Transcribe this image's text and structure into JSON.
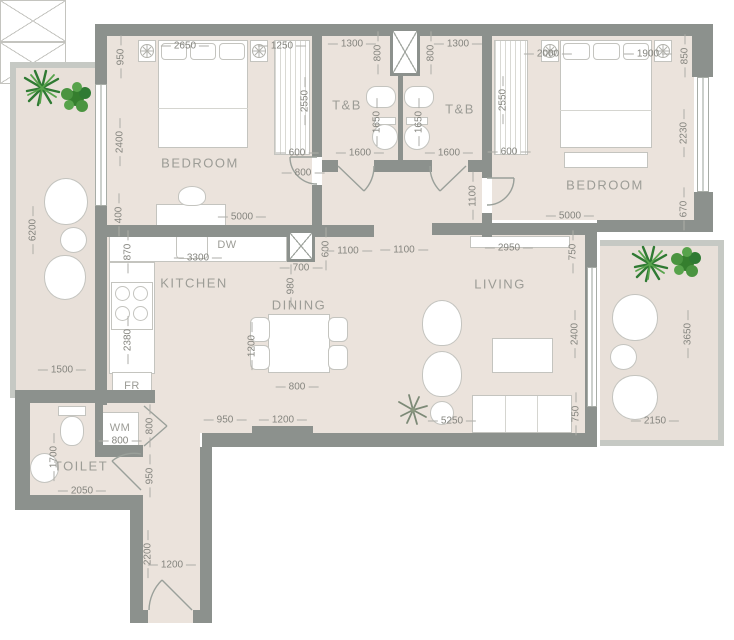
{
  "title": "apartment-floor-plan",
  "rooms": {
    "bedroom_left": "BEDROOM",
    "bedroom_right": "BEDROOM",
    "tb_left": "T&B",
    "tb_right": "T&B",
    "kitchen": "KITCHEN",
    "dining": "DINING",
    "living": "LIVING",
    "toilet": "TOILET"
  },
  "appliances": {
    "dishwasher": "DW",
    "fridge": "FR",
    "washing_machine": "WM"
  },
  "dims": {
    "top": [
      "2650",
      "1250",
      "1300",
      "800",
      "800",
      "1300",
      "2000",
      "1900",
      "850"
    ],
    "left_wall": [
      "950",
      "2400",
      "400"
    ],
    "left_balcony": [
      "6200",
      "1500"
    ],
    "closet_left": [
      "2550",
      "600"
    ],
    "closet_right": [
      "2550",
      "600"
    ],
    "tb": [
      "1650",
      "1650",
      "1600",
      "1600",
      "800",
      "1100"
    ],
    "bedroom_left": [
      "5000"
    ],
    "bedroom_right": [
      "5000",
      "2230",
      "670"
    ],
    "kitchen": [
      "870",
      "3300",
      "700",
      "600",
      "980",
      "2380"
    ],
    "hall": [
      "1100",
      "1100",
      "2950",
      "750"
    ],
    "dining": [
      "1200",
      "800"
    ],
    "living": [
      "2400",
      "750"
    ],
    "right_balcony": [
      "3650",
      "2150"
    ],
    "bottom": [
      "950",
      "1200",
      "5250"
    ],
    "toilet": [
      "1700",
      "2050",
      "800",
      "800",
      "950"
    ],
    "corridor": [
      "2200",
      "1200"
    ]
  },
  "colors": {
    "wall": "#8c918d",
    "floor": "#ebe3dc",
    "balcony_floor": "#e8e0d9",
    "dimension_text": "#85857f",
    "room_text": "#9c9c96",
    "plant_dark": "#2f7a33",
    "plant_light": "#57a34b"
  }
}
